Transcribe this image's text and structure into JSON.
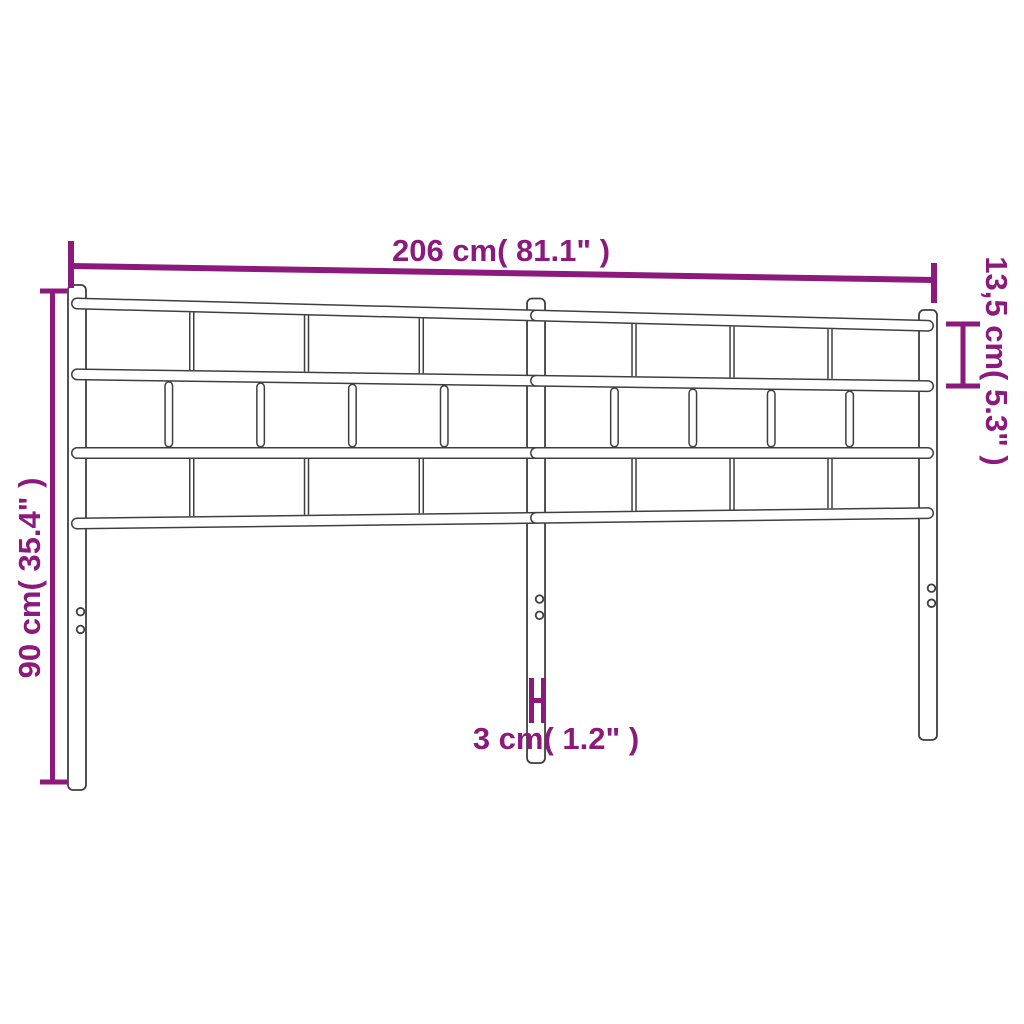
{
  "diagram": {
    "background_color": "#ffffff",
    "drawing_line_color": "#3f3f3f",
    "dimension_color": "#8c1a7c",
    "dimensions": {
      "width": {
        "label": "206 cm( 81.1\" )",
        "value_cm": 206,
        "value_in": 81.1
      },
      "height": {
        "label": "90 cm( 35.4\" )",
        "value_cm": 90,
        "value_in": 35.4
      },
      "top_section_height": {
        "label": "13,5 cm( 5.3\" )",
        "value_cm": 13.5,
        "value_in": 5.3
      },
      "post_width": {
        "label": "3 cm( 1.2\" )",
        "value_cm": 3,
        "value_in": 1.2
      }
    }
  }
}
